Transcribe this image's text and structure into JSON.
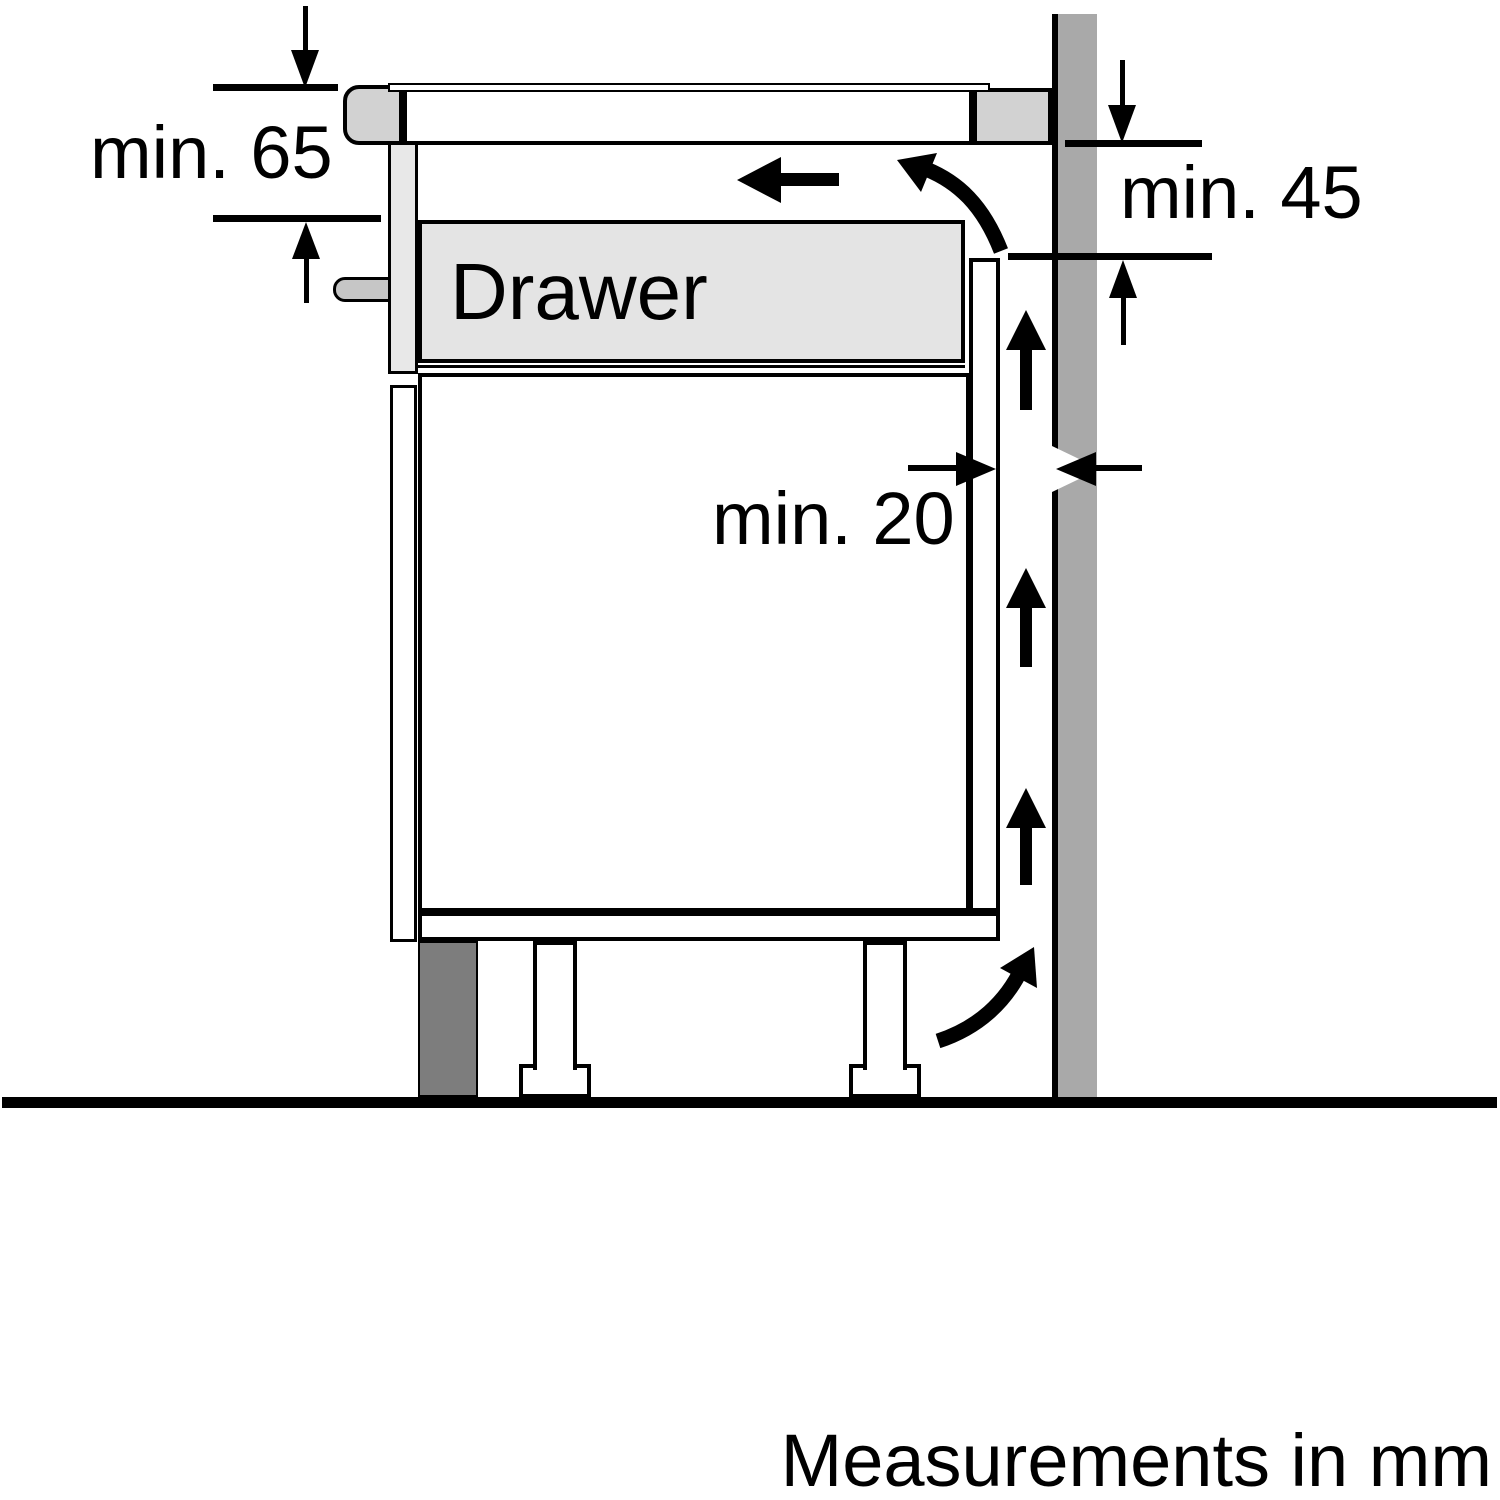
{
  "diagram": {
    "footer_note": "Measurements in mm",
    "drawer_label": "Drawer",
    "clearances": {
      "hob_front": {
        "label": "min. 65",
        "value_mm": 65
      },
      "side_wall": {
        "label": "min. 45",
        "value_mm": 45
      },
      "rear_gap": {
        "label": "min. 20",
        "value_mm": 20
      }
    },
    "colors": {
      "background": "#ffffff",
      "line": "#000000",
      "wall": "#a9a9a9",
      "plinth": "#7d7d7d",
      "drawer_fill": "#e4e4e4",
      "hob_trim": "#d2d2d2",
      "mounting_rail": "#e8e8e8",
      "fixing_pin": "#c6c6c6"
    },
    "icons": {
      "airflow": [
        "airflow-left-arrow-icon",
        "airflow-curve-top-icon",
        "airflow-up-arrow-icon",
        "airflow-curve-bottom-icon"
      ],
      "dimension": [
        "dim-arrow-down-icon",
        "dim-arrow-up-icon",
        "dim-arrow-left-icon",
        "dim-arrow-right-icon"
      ]
    }
  }
}
